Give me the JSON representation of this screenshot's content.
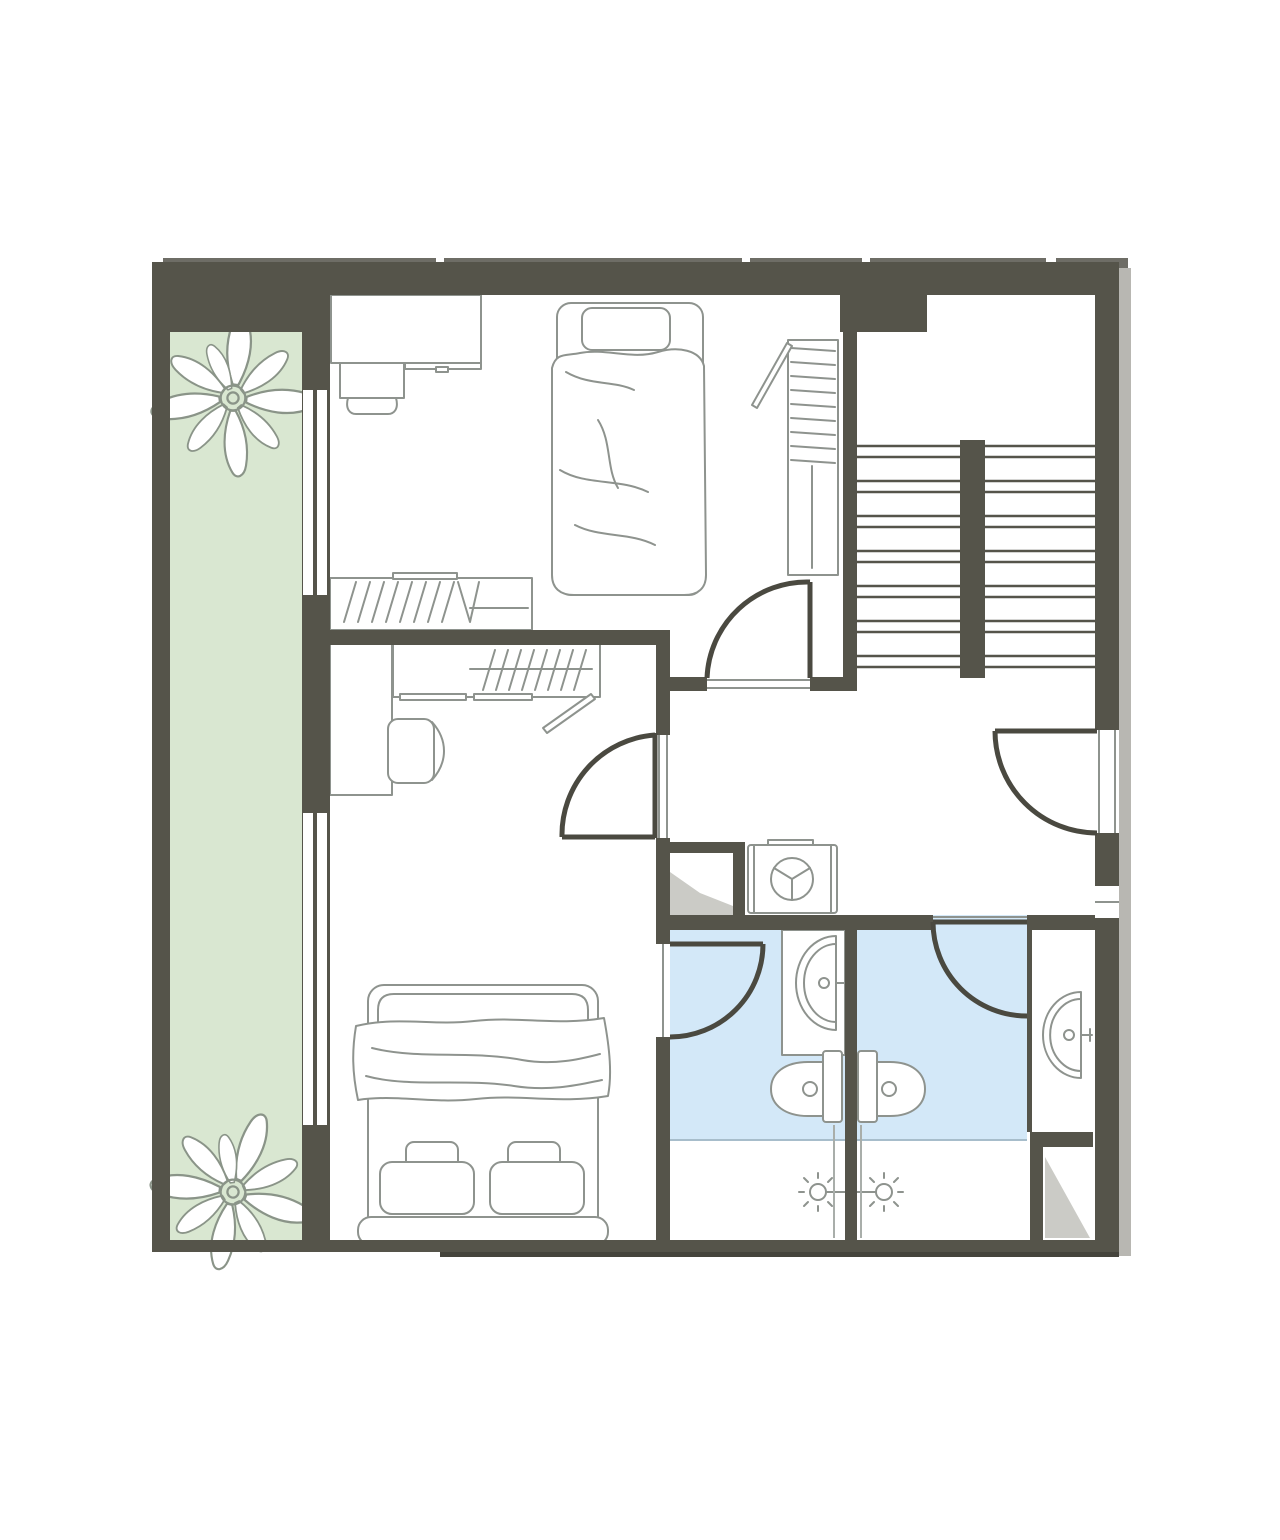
{
  "meta": {
    "kind": "architectural-floor-plan",
    "scale_text": ""
  },
  "colors": {
    "background": "#ffffff",
    "wall": "#55544a",
    "door_leaf": "#4a4940",
    "furniture_outline": "#8e938e",
    "balcony_floor": "#d9e7d1",
    "bathroom_floor": "#d3e8f8",
    "bathroom_floor_edge": "#a7bdcb",
    "plant_stroke": "#8a9488",
    "shaft_fill": "#cbcbc6",
    "side_shadow": "#b8b7b2",
    "top_strip": "#6e6d66",
    "bottom_edge": "#45443c",
    "thin_partition": "#a9aeaa",
    "white": "#ffffff"
  },
  "plan": {
    "rooms": [
      "balcony",
      "bedroom-1",
      "bedroom-2",
      "staircase",
      "hallway",
      "bathroom-1",
      "bathroom-2",
      "duct-shaft",
      "closet"
    ],
    "doors_count": 5,
    "windows_count": 3,
    "fixtures": {
      "balcony": [
        "plant",
        "plant"
      ],
      "bedroom_1": [
        "desk",
        "office-chair",
        "single-bed",
        "wardrobe",
        "clothes-rail",
        "shelf-unit"
      ],
      "bedroom_2": [
        "desk",
        "potted-plant",
        "wardrobe",
        "clothes-rail",
        "office-chair",
        "double-bed"
      ],
      "staircase": [
        "stair-flight-left",
        "stair-flight-right",
        "stair-spine-wall"
      ],
      "hallway": [
        "washing-machine",
        "duct-shaft"
      ],
      "bathroom_1": [
        "vanity",
        "sink",
        "toilet",
        "shower-head",
        "shower-area"
      ],
      "bathroom_2": [
        "sink-niche",
        "sink",
        "toilet",
        "shower-head",
        "shower-area",
        "closet"
      ]
    }
  }
}
